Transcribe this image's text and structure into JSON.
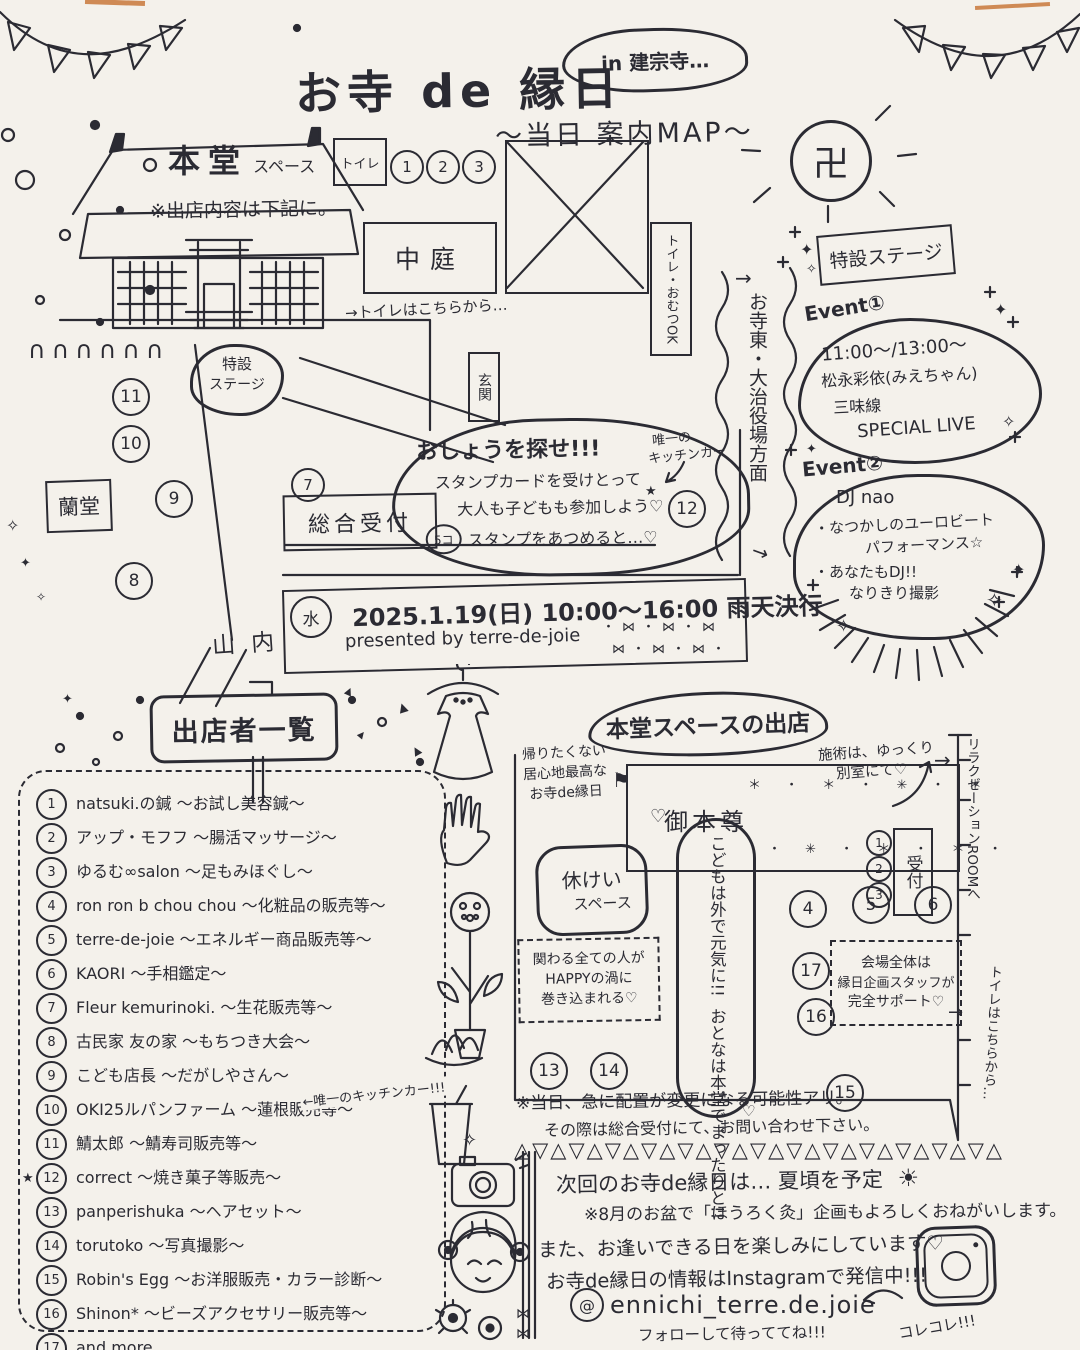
{
  "colors": {
    "ink": "#2b2b33",
    "paper": "#f4f1eb",
    "accent_orange": "#cf8a55"
  },
  "header": {
    "title": "お寺 de 縁日",
    "subtitle": "〜当日 案内MAP〜",
    "location": "in 建宗寺…"
  },
  "map": {
    "hondo_title": "本堂",
    "hondo_title_sub": "スペース",
    "hondo_note": "※出店内容は下記に。",
    "toilet": "トイレ",
    "courtyard": "中庭",
    "toilet_omutsu": "トイレ・おむつOK",
    "toilet_here": "→トイレはこちらから…",
    "stage_line1": "特設",
    "stage_line2": "ステージ",
    "genkan": "玄関",
    "rando": "蘭堂",
    "reception": "総合受付",
    "reception_badge": "7",
    "sannai": "山内",
    "east_arrow": "→",
    "east": "お寺東・大治役場方面",
    "fence": "∩∩∩∩∩∩",
    "top_badges": [
      "1",
      "2",
      "3"
    ],
    "left_badges": [
      "11",
      "10",
      "9",
      "8"
    ],
    "kitchen_badge": "12",
    "kitchen_note_l1": "唯一の",
    "kitchen_note_l2": "キッチンカー"
  },
  "stamp": {
    "l1": "おしょうを探せ!!!",
    "l2": "スタンプカードを受けとって",
    "l3": "大人も子どもも参加しよう♡",
    "count": "5コ",
    "l4": "スタンプをあつめると…♡"
  },
  "banner": {
    "water": "水",
    "date": "2025.1.19(日) 10:00〜16:00 雨天決行",
    "presented": "presented by terre-de-joie",
    "bows1": "・⋈・⋈・⋈",
    "bows2": "⋈・⋈・⋈・"
  },
  "stage": {
    "sign": "特設ステージ",
    "event1_title": "Event①",
    "event1": [
      "11:00〜/13:00〜",
      "松永彩依(みえちゃん)",
      "三味線",
      "SPECIAL LIVE"
    ],
    "event2_title": "Event②",
    "event2": [
      "DJ nao",
      "・なつかしのユーロビート",
      "　パフォーマンス☆",
      "・あなたもDJ!!",
      "　なりきり撮影"
    ]
  },
  "vendors": {
    "sign": "出店者一覧",
    "note": "←唯一のキッチンカー!!!",
    "star": "★",
    "items": [
      {
        "num": "1",
        "label": "natsuki.の鍼 〜お試し美容鍼〜"
      },
      {
        "num": "2",
        "label": "アップ・モフフ 〜腸活マッサージ〜"
      },
      {
        "num": "3",
        "label": "ゆるむ∞salon 〜足もみほぐし〜"
      },
      {
        "num": "4",
        "label": "ron ron b chou chou 〜化粧品の販売等〜"
      },
      {
        "num": "5",
        "label": "terre-de-joie 〜エネルギー商品販売等〜"
      },
      {
        "num": "6",
        "label": "KAORI 〜手相鑑定〜"
      },
      {
        "num": "7",
        "label": "Fleur kemurinoki. 〜生花販売等〜"
      },
      {
        "num": "8",
        "label": "古民家 友の家 〜もちつき大会〜"
      },
      {
        "num": "9",
        "label": "こども店長 〜だがしやさん〜"
      },
      {
        "num": "10",
        "label": "OKI25ルパンファーム 〜蓮根販売等〜"
      },
      {
        "num": "11",
        "label": "鯖太郎 〜鯖寿司販売等〜"
      },
      {
        "num": "12",
        "label": "correct 〜焼き菓子等販売〜"
      },
      {
        "num": "13",
        "label": "panperishuka 〜ヘアセット〜"
      },
      {
        "num": "14",
        "label": "torutoko 〜写真撮影〜"
      },
      {
        "num": "15",
        "label": "Robin's Egg 〜お洋服販売・カラー診断〜"
      },
      {
        "num": "16",
        "label": "Shinon* 〜ビーズアクセサリー販売等〜"
      },
      {
        "num": "17",
        "label": "and more…"
      }
    ]
  },
  "hondo": {
    "title": "本堂スペースの出店",
    "cozy_l1": "帰りたくない",
    "cozy_l2": "居心地最高な",
    "cozy_l3": "お寺de縁日",
    "gohonzon": "御本尊",
    "stars1": "＊ ・ ＊ ・ ✳ ・ ＊",
    "stars2": "・ ✳ ・ ＊ ・ ＊ ・",
    "sejutsu_l1": "施術は、ゆっくり",
    "sejutsu_l2": "別室にて♡",
    "relax": "リラクゼーションROOMへ",
    "rest_l1": "休けい",
    "rest_l2": "スペース",
    "happy_l1": "関わる全ての人が",
    "happy_l2": "HAPPYの渦に",
    "happy_l3": "巻き込まれる♡",
    "kids_l1": "こどもは外で元気に!!",
    "kids_l2": "おとなは本堂でまったりと!!",
    "reception_v": "受付",
    "support_l1": "会場全体は",
    "support_l2": "縁日企画スタッフが",
    "support_l3": "完全サポート♡",
    "toilet_v": "トイレはこちらから…",
    "badges": {
      "b1": "1",
      "b2": "2",
      "b3": "3",
      "b4": "4",
      "b5": "5",
      "b6": "6",
      "b13": "13",
      "b14": "14",
      "b15": "15",
      "b16": "16",
      "b17": "17"
    }
  },
  "notes": {
    "change1": "※当日、急に配置が変更になる可能性アリ。",
    "change2": "その際は総合受付にて、お問い合わせ下さい。"
  },
  "footer": {
    "divider": "△▽△▽△▽△▽△▽△▽△▽△▽△▽△▽△▽△▽△▽△",
    "next1": "次回のお寺de縁日は… 夏頃を予定",
    "next2": "※8月のお盆で「ほうろく灸」企画もよろしくおねがいします。",
    "next3": "また、お逢いできる日を楽しみにしています♡",
    "insta": "お寺de縁日の情報はInstagramで発信中!!!",
    "handle_at": "@",
    "handle": "ennichi_terre.de.joie",
    "follow": "フォローして待っててね!!!",
    "korekore": "コレコレ!!!"
  },
  "deco": {
    "sparkle": "✧",
    "sparkle2": "✦",
    "star": "★",
    "tri": "▲",
    "heart": "♡",
    "bow": "⋈",
    "flag": "⚑",
    "sun": "☀",
    "manji": "卍",
    "arrow_r": "→",
    "arrow_l": "←"
  }
}
